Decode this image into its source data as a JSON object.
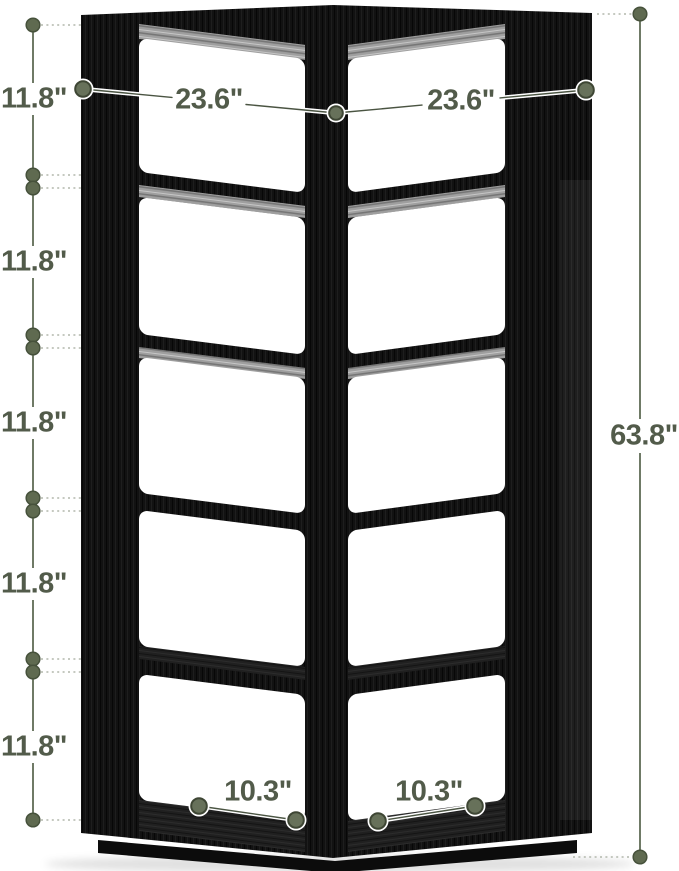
{
  "illustration": {
    "subject": "black corner bookshelf",
    "style": "product dimension diagram"
  },
  "dimensions": {
    "side_heights": [
      "11.8\"",
      "11.8\"",
      "11.8\"",
      "11.8\"",
      "11.8\""
    ],
    "top_widths": [
      "23.6\"",
      "23.6\""
    ],
    "total_height": "63.8\"",
    "bottom_depths": [
      "10.3\"",
      "10.3\""
    ]
  },
  "colors": {
    "annotation_text": "#525b4a",
    "marker_fill": "#67715a",
    "marker_ring": "#3e4634",
    "dim_line_light": "#ffffff",
    "dim_line_core": "#4a5442",
    "chain_line": "#6f7a66",
    "dotted_leader": "#b2b7ac",
    "wood_black": "#121212",
    "underside_gray": "#9f9f9f",
    "background": "#ffffff"
  }
}
